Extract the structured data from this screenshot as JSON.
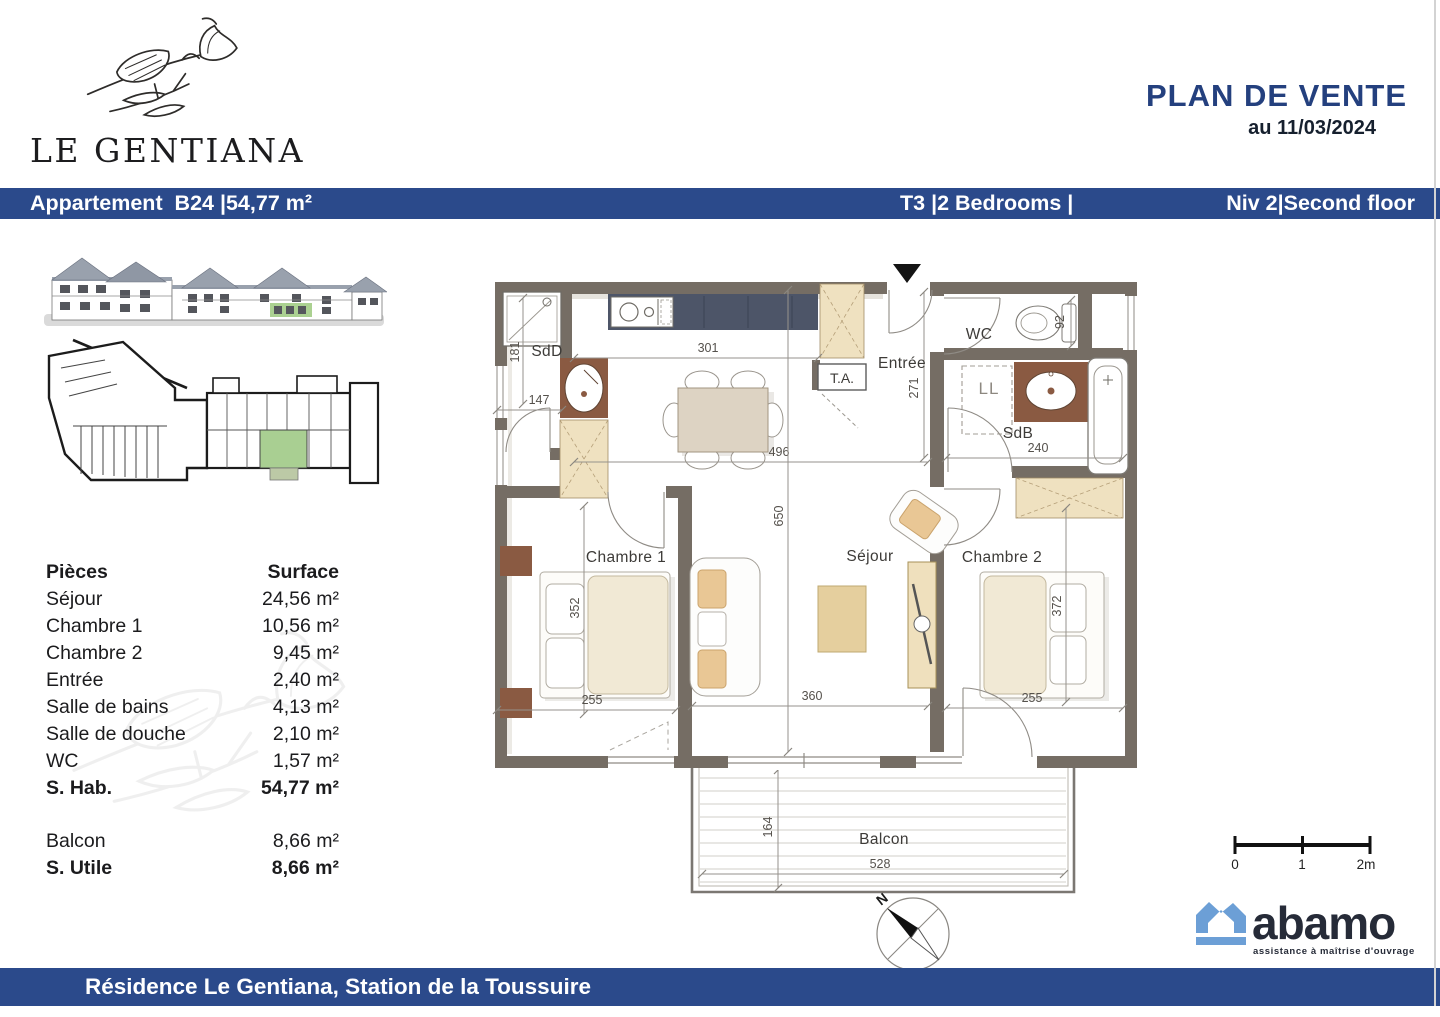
{
  "header": {
    "brand": "LE GENTIANA",
    "title": "PLAN DE VENTE",
    "date": "au 11/03/2024"
  },
  "title_bar": {
    "left": "Appartement  B24 |54,77 m²",
    "type": "T3 |2 Bedrooms |",
    "level": "Niv 2|Second floor"
  },
  "surface_table": {
    "col_rooms": "Pièces",
    "col_surface": "Surface",
    "rows": [
      {
        "label": "Séjour",
        "value": "24,56 m²"
      },
      {
        "label": "Chambre 1",
        "value": "10,56 m²"
      },
      {
        "label": "Chambre 2",
        "value": "9,45 m²"
      },
      {
        "label": "Entrée",
        "value": "2,40 m²"
      },
      {
        "label": "Salle de bains",
        "value": "4,13 m²"
      },
      {
        "label": "Salle de douche",
        "value": "2,10 m²"
      },
      {
        "label": "WC",
        "value": "1,57 m²"
      },
      {
        "label": "S. Hab.",
        "value": "54,77 m²"
      }
    ],
    "annex_rows": [
      {
        "label": "Balcon",
        "value": "8,66 m²"
      },
      {
        "label": "S. Utile",
        "value": "8,66 m²"
      }
    ]
  },
  "floor_plan": {
    "rooms": {
      "sdd": "SdD",
      "wc": "WC",
      "sdb": "SdB",
      "entree": "Entrée",
      "ta": "T.A.",
      "ll": "LL",
      "chambre1": "Chambre 1",
      "sejour": "Séjour",
      "chambre2": "Chambre 2",
      "balcon": "Balcon"
    },
    "dims": {
      "sdd_height": "181",
      "sdd_width": "147",
      "kitchen_width": "301",
      "sejour_width": "496",
      "sejour_height": "650",
      "entree_height": "271",
      "wc_width": "92",
      "sdb_width": "240",
      "ch1_height": "352",
      "ch1_width": "255",
      "sejour_bay": "360",
      "ch2_height": "372",
      "ch2_width": "255",
      "balcon_height": "164",
      "balcon_width": "528"
    },
    "north": "N"
  },
  "scale_bar": {
    "t0": "0",
    "t1": "1",
    "t2": "2m"
  },
  "branding": {
    "logo_text": "abamo",
    "tagline": "assistance à maîtrise d'ouvrage"
  },
  "footer": {
    "text": "Résidence Le Gentiana, Station de la Toussuire"
  },
  "colors": {
    "bar_blue": "#2b4a8b",
    "title_blue": "#24407e",
    "wall": "#756d64",
    "furniture_beige": "#efe1c0",
    "counter_brown": "#8a5a42",
    "kitchen_counter": "#4d5568",
    "highlight_green": "#a9cf92",
    "logo_blue": "#6c9fd6",
    "logo_dark": "#262b38"
  }
}
